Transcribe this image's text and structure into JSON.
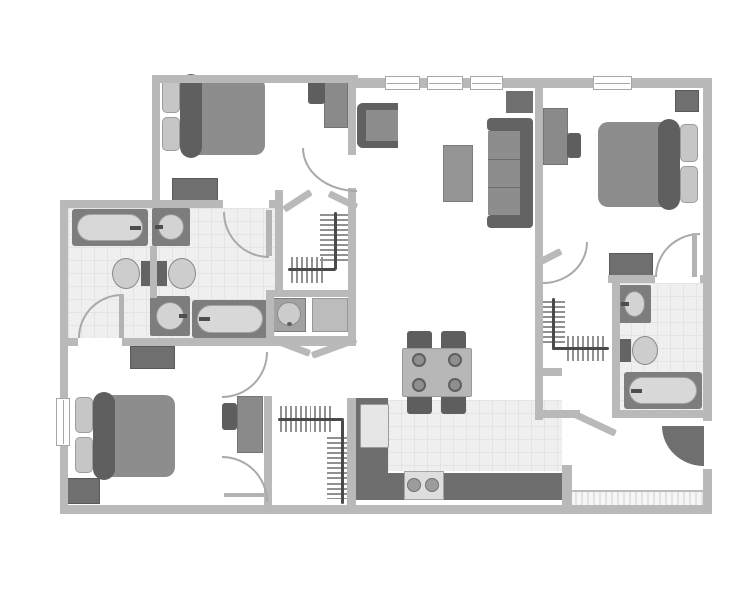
{
  "plan": {
    "type": "apartment-floor-plan",
    "canvas": {
      "w": 753,
      "h": 599
    },
    "palette": {
      "wall": "#b9b9b9",
      "tile_floor": "#efefef",
      "furniture_mid": "#8d8d8d",
      "furniture_dark": "#6f6f6f",
      "headboard_dark": "#5f5f5f",
      "fixture_light": "#d8d8d8",
      "arc": "#a9a9a9",
      "rod": "#4a4a4a",
      "background": "#ffffff"
    },
    "rooms": [
      {
        "name": "bedroom-1",
        "area": "top-left"
      },
      {
        "name": "bedroom-2",
        "area": "top-right"
      },
      {
        "name": "bedroom-3",
        "area": "bottom-left"
      },
      {
        "name": "living-room",
        "area": "top-center"
      },
      {
        "name": "dining-area",
        "area": "center"
      },
      {
        "name": "kitchen",
        "area": "bottom-center"
      },
      {
        "name": "bathroom-1",
        "area": "mid-left-upper"
      },
      {
        "name": "bathroom-2",
        "area": "mid-left-lower"
      },
      {
        "name": "bathroom-3",
        "area": "right"
      },
      {
        "name": "walk-in-closet-1",
        "area": "center-upper"
      },
      {
        "name": "walk-in-closet-2",
        "area": "center-lower"
      },
      {
        "name": "walk-in-closet-3",
        "area": "right-middle"
      },
      {
        "name": "laundry-nook",
        "area": "center"
      },
      {
        "name": "entry",
        "area": "bottom-right"
      }
    ],
    "floors": [
      {
        "name": "bathroom12-floor",
        "rect": [
          68,
          208,
          207,
          130
        ],
        "style": "tile"
      },
      {
        "name": "bathroom3-floor",
        "rect": [
          618,
          283,
          85,
          127
        ],
        "style": "tile"
      },
      {
        "name": "kitchen-floor",
        "rect": [
          388,
          400,
          174,
          71
        ],
        "style": "tile"
      },
      {
        "name": "entry-threshold",
        "rect": [
          563,
          490,
          140,
          15
        ],
        "style": "hatch"
      }
    ],
    "walls": [
      [
        152,
        75,
        206,
        8
      ],
      [
        152,
        75,
        8,
        133
      ],
      [
        352,
        78,
        360,
        10
      ],
      [
        703,
        78,
        9,
        435
      ],
      [
        60,
        505,
        652,
        9
      ],
      [
        60,
        200,
        8,
        313
      ],
      [
        60,
        200,
        163,
        8
      ],
      [
        269,
        200,
        14,
        8
      ],
      [
        275,
        190,
        8,
        104
      ],
      [
        266,
        290,
        8,
        56
      ],
      [
        266,
        290,
        90,
        7
      ],
      [
        348,
        75,
        8,
        80
      ],
      [
        348,
        188,
        8,
        150
      ],
      [
        268,
        336,
        88,
        10
      ],
      [
        150,
        246,
        7,
        52
      ],
      [
        264,
        396,
        8,
        109
      ],
      [
        347,
        398,
        9,
        107
      ],
      [
        60,
        338,
        18,
        8
      ],
      [
        122,
        338,
        158,
        8
      ],
      [
        535,
        86,
        8,
        198
      ],
      [
        535,
        283,
        8,
        137
      ],
      [
        612,
        283,
        8,
        135
      ],
      [
        608,
        275,
        47,
        8
      ],
      [
        700,
        275,
        12,
        8
      ],
      [
        612,
        410,
        100,
        8
      ],
      [
        535,
        410,
        45,
        8
      ],
      [
        535,
        368,
        27,
        8
      ],
      [
        562,
        465,
        10,
        40
      ]
    ],
    "diagonals": [
      [
        284,
        206,
        32,
        -33
      ],
      [
        329,
        190,
        31,
        26
      ],
      [
        268,
        334,
        45,
        21
      ],
      [
        312,
        352,
        47,
        -20
      ],
      [
        573,
        410,
        47,
        25
      ],
      [
        537,
        260,
        27,
        -27
      ]
    ],
    "windows": {
      "horizontal": [
        [
          385,
          76,
          35,
          14
        ],
        [
          427,
          76,
          36,
          14
        ],
        [
          470,
          76,
          33,
          14
        ],
        [
          593,
          76,
          39,
          14
        ]
      ],
      "vertical": [
        [
          56,
          398,
          14,
          48
        ]
      ]
    },
    "doors": {
      "arcs": [
        {
          "name": "bathroom1-door-arc",
          "x": 78,
          "y": 294,
          "w": 44,
          "h": 44,
          "corner": "tl"
        },
        {
          "name": "bedroom1-bath-door-arc",
          "x": 223,
          "y": 212,
          "w": 46,
          "h": 46,
          "corner": "bl"
        },
        {
          "name": "bedroom3-door-arc",
          "x": 222,
          "y": 352,
          "w": 46,
          "h": 46,
          "corner": "br"
        },
        {
          "name": "bedroom3-closet-door-arc",
          "x": 222,
          "y": 456,
          "w": 46,
          "h": 46,
          "corner": "tr"
        },
        {
          "name": "bedroom1-entry-door-arc",
          "x": 302,
          "y": 148,
          "w": 55,
          "h": 44,
          "corner": "bl"
        },
        {
          "name": "bedroom2-door-arc",
          "x": 655,
          "y": 233,
          "w": 45,
          "h": 44,
          "corner": "tl"
        },
        {
          "name": "hall-door-arc",
          "x": 543,
          "y": 242,
          "w": 45,
          "h": 42,
          "corner": "br"
        }
      ],
      "leaves": [
        [
          119,
          294,
          5,
          44
        ],
        [
          266,
          210,
          6,
          46
        ],
        [
          692,
          233,
          5,
          44
        ],
        [
          224,
          493,
          40,
          4
        ]
      ],
      "entry_wedge": {
        "x": 662,
        "y": 426,
        "w": 42,
        "h": 40
      },
      "entry_gap": [
        701,
        421,
        13,
        48
      ]
    },
    "furniture": {
      "beds": [
        {
          "name": "bed-bedroom1",
          "x": 162,
          "y": 77,
          "w": 103,
          "h": 78,
          "head": "left"
        },
        {
          "name": "bed-bedroom2",
          "x": 598,
          "y": 122,
          "w": 100,
          "h": 85,
          "head": "right"
        },
        {
          "name": "bed-bedroom3",
          "x": 75,
          "y": 395,
          "w": 100,
          "h": 82,
          "head": "left"
        }
      ],
      "bathtubs": [
        {
          "name": "bathtub-1",
          "x": 72,
          "y": 209,
          "w": 76,
          "h": 37,
          "faucet": "right"
        },
        {
          "name": "bathtub-2",
          "x": 192,
          "y": 300,
          "w": 76,
          "h": 38,
          "faucet": "left"
        },
        {
          "name": "bathtub-3",
          "x": 624,
          "y": 372,
          "w": 78,
          "h": 37,
          "faucet": "left"
        }
      ],
      "sinks": [
        {
          "name": "sink-1",
          "x": 152,
          "y": 208,
          "w": 38,
          "h": 38,
          "faucet": "left"
        },
        {
          "name": "sink-2",
          "x": 150,
          "y": 296,
          "w": 40,
          "h": 40,
          "faucet": "right"
        },
        {
          "name": "sink-3",
          "x": 618,
          "y": 285,
          "w": 33,
          "h": 38,
          "faucet": "left"
        }
      ],
      "toilets": [
        {
          "name": "toilet-1",
          "x": 112,
          "y": 258,
          "w": 40,
          "h": 31,
          "facing": "left"
        },
        {
          "name": "toilet-2",
          "x": 156,
          "y": 258,
          "w": 40,
          "h": 31,
          "facing": "right"
        },
        {
          "name": "toilet-3",
          "x": 620,
          "y": 336,
          "w": 38,
          "h": 29,
          "facing": "right"
        }
      ],
      "dressers": [
        {
          "name": "dresser-bedroom1",
          "x": 172,
          "y": 178,
          "w": 46,
          "h": 26
        },
        {
          "name": "dresser-bedroom3",
          "x": 130,
          "y": 346,
          "w": 45,
          "h": 23
        },
        {
          "name": "dresser-bedroom2",
          "x": 609,
          "y": 253,
          "w": 44,
          "h": 24
        },
        {
          "name": "nightstand-bedroom2",
          "x": 675,
          "y": 90,
          "w": 24,
          "h": 22
        },
        {
          "name": "nightstand-bedroom3",
          "x": 64,
          "y": 478,
          "w": 36,
          "h": 26
        }
      ],
      "desks": [
        {
          "name": "desk-bedroom1",
          "desk": [
            324,
            77,
            24,
            51
          ],
          "chair": [
            308,
            79,
            17,
            25
          ]
        },
        {
          "name": "desk-bedroom2",
          "desk": [
            543,
            108,
            25,
            57
          ],
          "chair": [
            567,
            133,
            14,
            25
          ]
        },
        {
          "name": "desk-bedroom3",
          "desk": [
            237,
            396,
            26,
            57
          ],
          "chair": [
            222,
            403,
            15,
            27
          ]
        }
      ],
      "sofa": {
        "x": 487,
        "y": 118,
        "w": 46,
        "h": 110
      },
      "armchair": {
        "x": 357,
        "y": 103,
        "w": 41,
        "h": 45
      },
      "coffee_table": {
        "x": 443,
        "y": 145,
        "w": 30,
        "h": 57
      },
      "tv_stand": {
        "x": 506,
        "y": 91,
        "w": 27,
        "h": 22
      },
      "dining": {
        "table": [
          402,
          348,
          70,
          49
        ],
        "chairs": [
          [
            407,
            331,
            25,
            20
          ],
          [
            441,
            331,
            25,
            20
          ],
          [
            407,
            394,
            25,
            20
          ],
          [
            441,
            394,
            25,
            20
          ]
        ],
        "plates": [
          [
            419,
            360
          ],
          [
            455,
            360
          ],
          [
            419,
            385
          ],
          [
            455,
            385
          ]
        ]
      },
      "kitchen": {
        "counters": [
          [
            356,
            398,
            32,
            102
          ],
          [
            356,
            473,
            206,
            27
          ]
        ],
        "fridge": [
          360,
          404,
          29,
          44
        ],
        "stove": {
          "rect": [
            404,
            471,
            40,
            29
          ],
          "burners": [
            [
              414,
              485
            ],
            [
              432,
              485
            ]
          ]
        }
      },
      "laundry": {
        "washer": [
          272,
          298,
          34,
          34
        ],
        "dryer": [
          312,
          298,
          36,
          34
        ]
      }
    },
    "closet_rods": [
      {
        "name": "closet1-rod",
        "lines": [
          [
            334,
            212,
            3,
            58
          ],
          [
            288,
            268,
            48,
            3
          ]
        ],
        "ticks": [
          [
            320,
            214,
            28,
            50,
            "h"
          ],
          [
            291,
            257,
            34,
            26,
            "v"
          ]
        ]
      },
      {
        "name": "closet2-rod",
        "lines": [
          [
            278,
            418,
            66,
            3
          ],
          [
            341,
            420,
            3,
            84
          ]
        ],
        "ticks": [
          [
            280,
            406,
            31,
            26,
            "v"
          ],
          [
            314,
            406,
            19,
            26,
            "v"
          ],
          [
            327,
            437,
            29,
            43,
            "h"
          ],
          [
            327,
            483,
            29,
            16,
            "h"
          ]
        ]
      },
      {
        "name": "closet3-rod",
        "lines": [
          [
            552,
            298,
            3,
            52
          ],
          [
            552,
            347,
            57,
            3
          ]
        ],
        "ticks": [
          [
            540,
            301,
            25,
            44,
            "h"
          ],
          [
            567,
            336,
            39,
            25,
            "v"
          ]
        ]
      }
    ]
  }
}
